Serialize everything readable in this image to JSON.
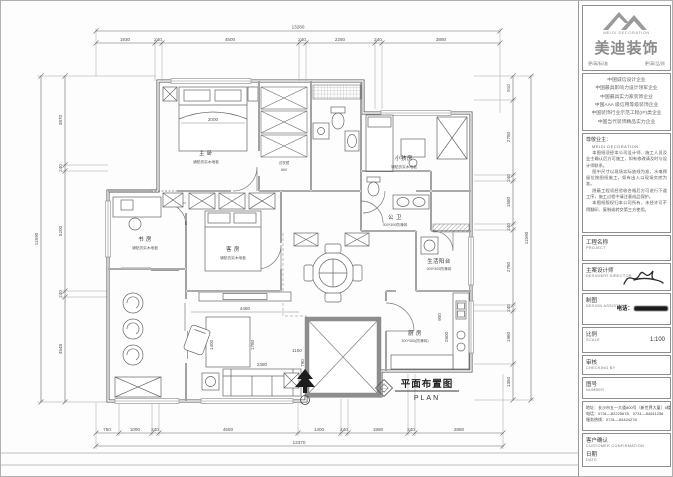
{
  "drawing": {
    "title_cn": "平面布置图",
    "title_en": "PLAN",
    "rooms": {
      "master": {
        "name": "主 卧",
        "note": "铺贴仿实木地板"
      },
      "kids": {
        "name": "小孩房",
        "note": "铺贴仿实木地板"
      },
      "study": {
        "name": "书 房",
        "note": "铺贴仿实木地板"
      },
      "guest": {
        "name": "客 房",
        "note": "铺贴仿实木地板"
      },
      "bath": {
        "name": "公 卫",
        "note": "300*300防滑砖"
      },
      "service": {
        "name": "生活阳台",
        "note": "300*300防滑砖"
      },
      "kitchen": {
        "name": "厨 房",
        "note": "300*300(防滑砖)"
      },
      "mirror_label": "试衣镜"
    },
    "dims": {
      "top": {
        "total": "13280",
        "segments": [
          "1930",
          "240",
          "4500",
          "240",
          "2250",
          "240",
          "3880"
        ]
      },
      "bottom": {
        "total": "13370",
        "segments": [
          "750",
          "1090",
          "240",
          "4550",
          "1400",
          "240",
          "1980",
          "240",
          "2880"
        ]
      },
      "left": {
        "total": "11590",
        "segments": [
          "3870",
          "240",
          "5200",
          "240",
          "4548"
        ]
      },
      "right": {
        "total": "11590",
        "segments": [
          "910",
          "2780",
          "240",
          "1580",
          "240",
          "2780",
          "240",
          "1960",
          "1350"
        ]
      },
      "inner": {
        "bed": "2000",
        "living": "4480",
        "rug_w": "1400",
        "rug_h": "1780",
        "sofa": "2380",
        "sofa_d": "790",
        "kitchen_w": "2600",
        "kitchen_d": "900",
        "hall": "1150",
        "closet": "660"
      }
    }
  },
  "panel": {
    "logo": {
      "en1": "MEIDI",
      "en2": "DECORATION",
      "cn": "美迪装饰",
      "slogan_l": "更/高/标/准",
      "slogan_r": "更/高/品/质"
    },
    "certs": [
      "中国诚信设计企业",
      "中国最具影响力设计领军企业",
      "中国最具实力家装饰企业",
      "中国AAA 级信用等级装饰企业",
      "中国装饰行业示范工程(IP)类企业",
      "中国当代装饰精品实力企业"
    ],
    "notes": {
      "salute": "尊敬业主：",
      "sub": "MEIDI DECORATION",
      "paras": [
        "本图纸须经本公司设计师、施工人员及业主确认后方可施工，如有修改请及时与设计师联系。",
        "图中尺寸以现场实际放线为准，水电预留位按图纸施工，如有出入以现场交底为准。",
        "隐蔽工程须经验收合格后方可进行下道工序，施工过程中请注意成品保护。",
        "本图纸版权归本公司所有，未经许可不得翻印、复制或转交第三方使用。"
      ]
    },
    "fields": {
      "project": {
        "cn": "工程名称",
        "en": "PROJECT"
      },
      "designer": {
        "cn": "主案设计师",
        "en": "DESIGNER DIRECTOR"
      },
      "drafter": {
        "cn": "制图",
        "en": "DESIGN ASSISTANT",
        "phone_label": "电话："
      },
      "scale": {
        "cn": "比例",
        "en": "SCALE",
        "value": "1:100"
      },
      "check": {
        "cn": "审核",
        "en": "CHECKING BY"
      },
      "number": {
        "cn": "图号",
        "en": "NUMBER"
      },
      "confirm": {
        "cn": "客户确认",
        "en": "CUSTOMER CONFIRMATION"
      },
      "date": {
        "cn": "日期",
        "en": "DATE"
      }
    },
    "address": [
      "地址：长沙市五一大道800号（新世界大厦）5楼",
      "电话：0731—82225678　0731—84441258",
      "服务热线：0731—84404278"
    ]
  }
}
